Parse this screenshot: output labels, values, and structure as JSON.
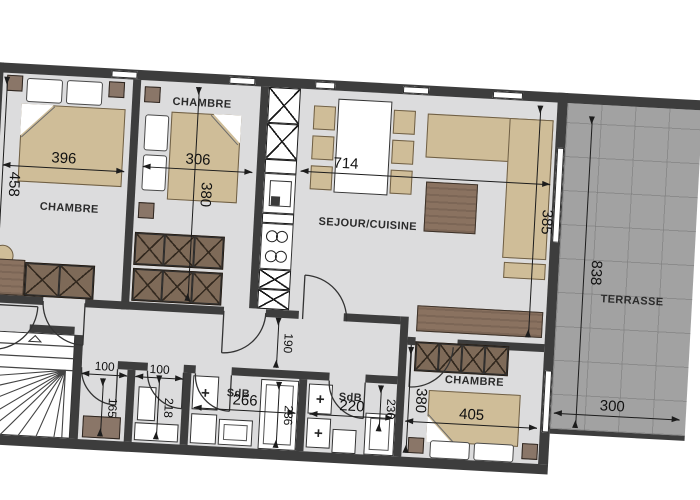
{
  "colors": {
    "wall": "#3d3d3d",
    "floor": "#dcdcdd",
    "terrace": "#a2a2a2",
    "wood": "#8a7260",
    "fabric": "#cfbd98",
    "cabinet": "#7e6a58"
  },
  "rooms": {
    "chambre1": {
      "label": "CHAMBRE",
      "width_cm": "396",
      "height_cm": "458"
    },
    "chambre2": {
      "label": "CHAMBRE",
      "width_cm": "306",
      "height_cm": "380"
    },
    "sejour": {
      "label": "SEJOUR/CUISINE",
      "width_cm": "714",
      "height_cm": "385"
    },
    "hall": {
      "width_cm": "190"
    },
    "closet1": {
      "width_cm": "100",
      "height_cm": "165"
    },
    "closet2": {
      "width_cm": "100",
      "height_cm": "218"
    },
    "sdb1": {
      "label": "SdB",
      "width_cm": "266",
      "shower_cm": "236"
    },
    "sdb2": {
      "label": "SdB",
      "width_cm": "220",
      "shower_cm": "236"
    },
    "chambre3": {
      "label": "CHAMBRE",
      "width_cm": "405",
      "height_cm": "380"
    },
    "terrasse": {
      "label": "TERRASSE",
      "width_cm": "300",
      "height_cm": "838"
    }
  }
}
